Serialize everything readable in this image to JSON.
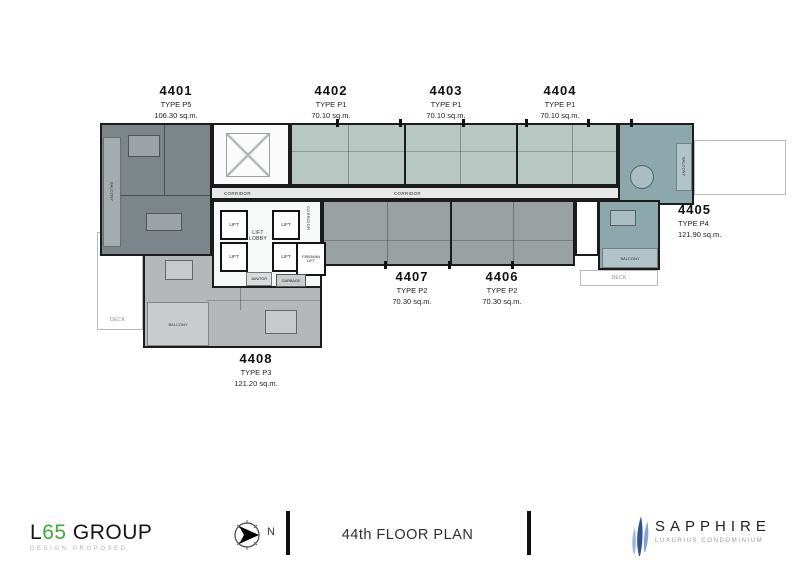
{
  "plan": {
    "units": [
      {
        "number": "4401",
        "type": "TYPE P5",
        "area": "106.30 sq.m."
      },
      {
        "number": "4402",
        "type": "TYPE P1",
        "area": "70.10 sq.m."
      },
      {
        "number": "4403",
        "type": "TYPE P1",
        "area": "70.10 sq.m."
      },
      {
        "number": "4404",
        "type": "TYPE P1",
        "area": "70.10 sq.m."
      },
      {
        "number": "4405",
        "type": "TYPE P4",
        "area": "121.90 sq.m."
      },
      {
        "number": "4406",
        "type": "TYPE P2",
        "area": "70.30 sq.m."
      },
      {
        "number": "4407",
        "type": "TYPE P2",
        "area": "70.30 sq.m."
      },
      {
        "number": "4408",
        "type": "TYPE P3",
        "area": "121.20 sq.m."
      }
    ],
    "rooms": {
      "corridor": "CORRIDOR",
      "lift_lobby": "LIFT LOBBY",
      "lift": "LIFT",
      "fireman_lift": "FIREMAN LIFT",
      "garbage": "GARBAGE",
      "janitor": "JANITOR",
      "balcony": "BALCONY",
      "deck": "DECK"
    },
    "colors": {
      "unit_4401": "#7b858a",
      "units_4402_4404": "#b7c7c2",
      "unit_4405": "#8ca8ad",
      "units_4406_4407": "#9aa1a3",
      "unit_4408": "#b5b8b9",
      "corridor": "#e7e9e9",
      "walls": "#1c1c1c"
    }
  },
  "footer": {
    "l65": {
      "l": "L",
      "sixtyfive": "65",
      "group": " GROUP",
      "tagline": "DESIGN PROPOSED",
      "accent_green": "#3aaa35"
    },
    "compass": {
      "north": "N"
    },
    "plan_title": "44th FLOOR PLAN",
    "sapphire": {
      "name": "SAPPHIRE",
      "tagline": "LUXURIUS CONDOMINIUM",
      "brand_blue": "#2f5391"
    }
  }
}
